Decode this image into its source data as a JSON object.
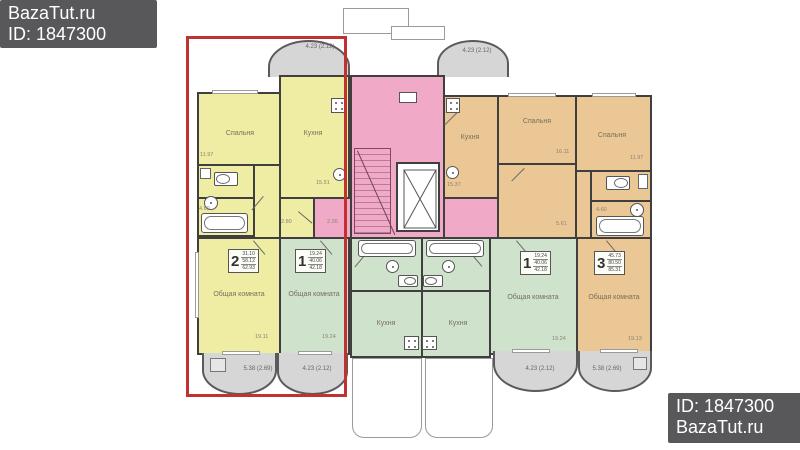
{
  "watermarks": {
    "top": {
      "line1": "BazaTut.ru",
      "line2": "ID: 1847300"
    },
    "bottom": {
      "line1": "ID: 1847300",
      "line2": "BazaTut.ru"
    }
  },
  "highlight_color": "#c0322f",
  "palette": {
    "two_room_apartment": "#efeca3",
    "one_room_apartment": "#cfe2cb",
    "stair_core": "#f0a9c6",
    "three_room_apartment": "#eac795",
    "balcony": "#d6d6d6"
  },
  "room_labels": {
    "bedroom": "Спальня",
    "kitchen": "Кухня",
    "living_room": "Общая комната"
  },
  "apartments": {
    "apt2": {
      "number": "2",
      "living_area": "31.10",
      "area": "58.12",
      "total_area": "62.93"
    },
    "apt1_left": {
      "number": "1",
      "living_area": "19.24",
      "area": "40.06",
      "total_area": "42.18"
    },
    "apt1_right": {
      "number": "1",
      "living_area": "19.24",
      "area": "40.06",
      "total_area": "42.18"
    },
    "apt3": {
      "number": "3",
      "living_area": "45.73",
      "area": "80.50",
      "total_area": "85.31"
    }
  },
  "balcony_labels": {
    "top_left": "4.23 (2.12)",
    "top_right": "4.23 (2.12)",
    "bottom_far_left": "5.38 (2.69)",
    "bottom_left": "4.23 (2.12)",
    "bottom_right": "4.23 (2.12)",
    "bottom_far_right": "5.38 (2.69)"
  },
  "dimensions": {
    "bedroom_left": "11.97",
    "kitchen_left": "15.51",
    "hall_left": "2.80",
    "corridor": "2.26",
    "living_apt2": "19.11",
    "living_apt1_left": "19.24",
    "bath_left": "4.60",
    "bedroom_mid": "16.11",
    "kitchen_right": "15.37",
    "bedroom_right": "11.97",
    "living_apt1_right": "19.24",
    "living_apt3": "19.13",
    "hall_right": "5.61",
    "bath_right": "4.60"
  }
}
